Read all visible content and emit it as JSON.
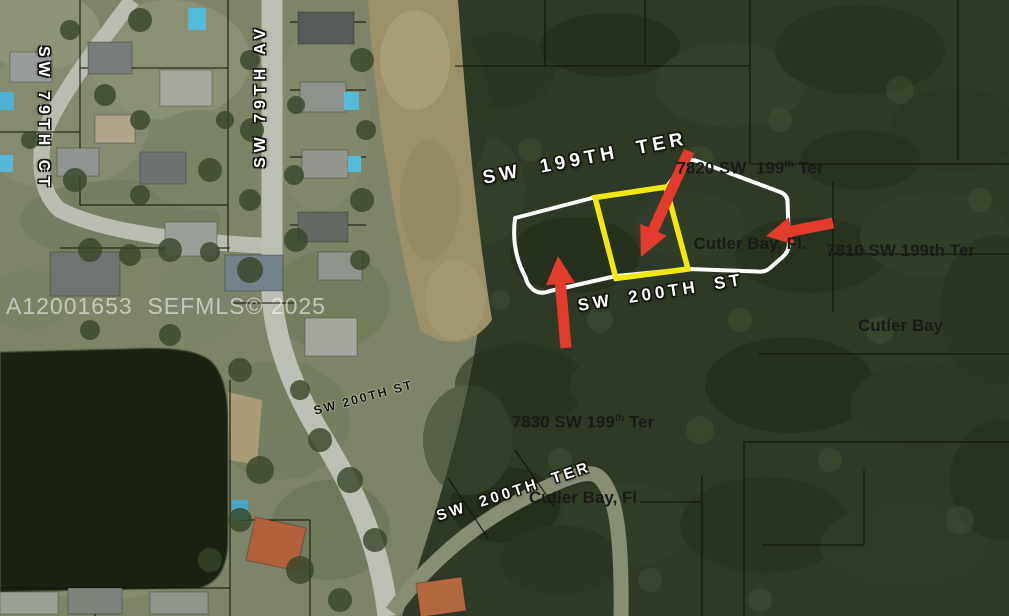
{
  "watermark": {
    "text": "A12001653  SEFMLS© 2025"
  },
  "streets": {
    "sw199ter": "SW 199TH TER",
    "sw200st_white": "SW 200TH ST",
    "sw200st_black": "SW 200TH ST",
    "sw200ter": "SW 200TH TER",
    "sw79ct": "SW 79TH CT",
    "sw79av": "SW 79TH AV"
  },
  "labels": {
    "l7820": {
      "line1_a": "7820 SW  199",
      "line1_sup": "th",
      "line1_b": " Ter",
      "line2": "Cutler Bay, Fl."
    },
    "l7810": {
      "line1": "7810 SW 199th Ter",
      "line2": "Cutler Bay"
    },
    "l7830": {
      "line1_a": "7830 SW 199",
      "line1_sup": "th",
      "line1_b": " Ter",
      "line2": "Cutler Bay, Fl"
    }
  },
  "colors": {
    "parcel_highlight": "#f2e70e",
    "parcel_outline": "#ffffff",
    "arrow": "#e23a2c"
  }
}
